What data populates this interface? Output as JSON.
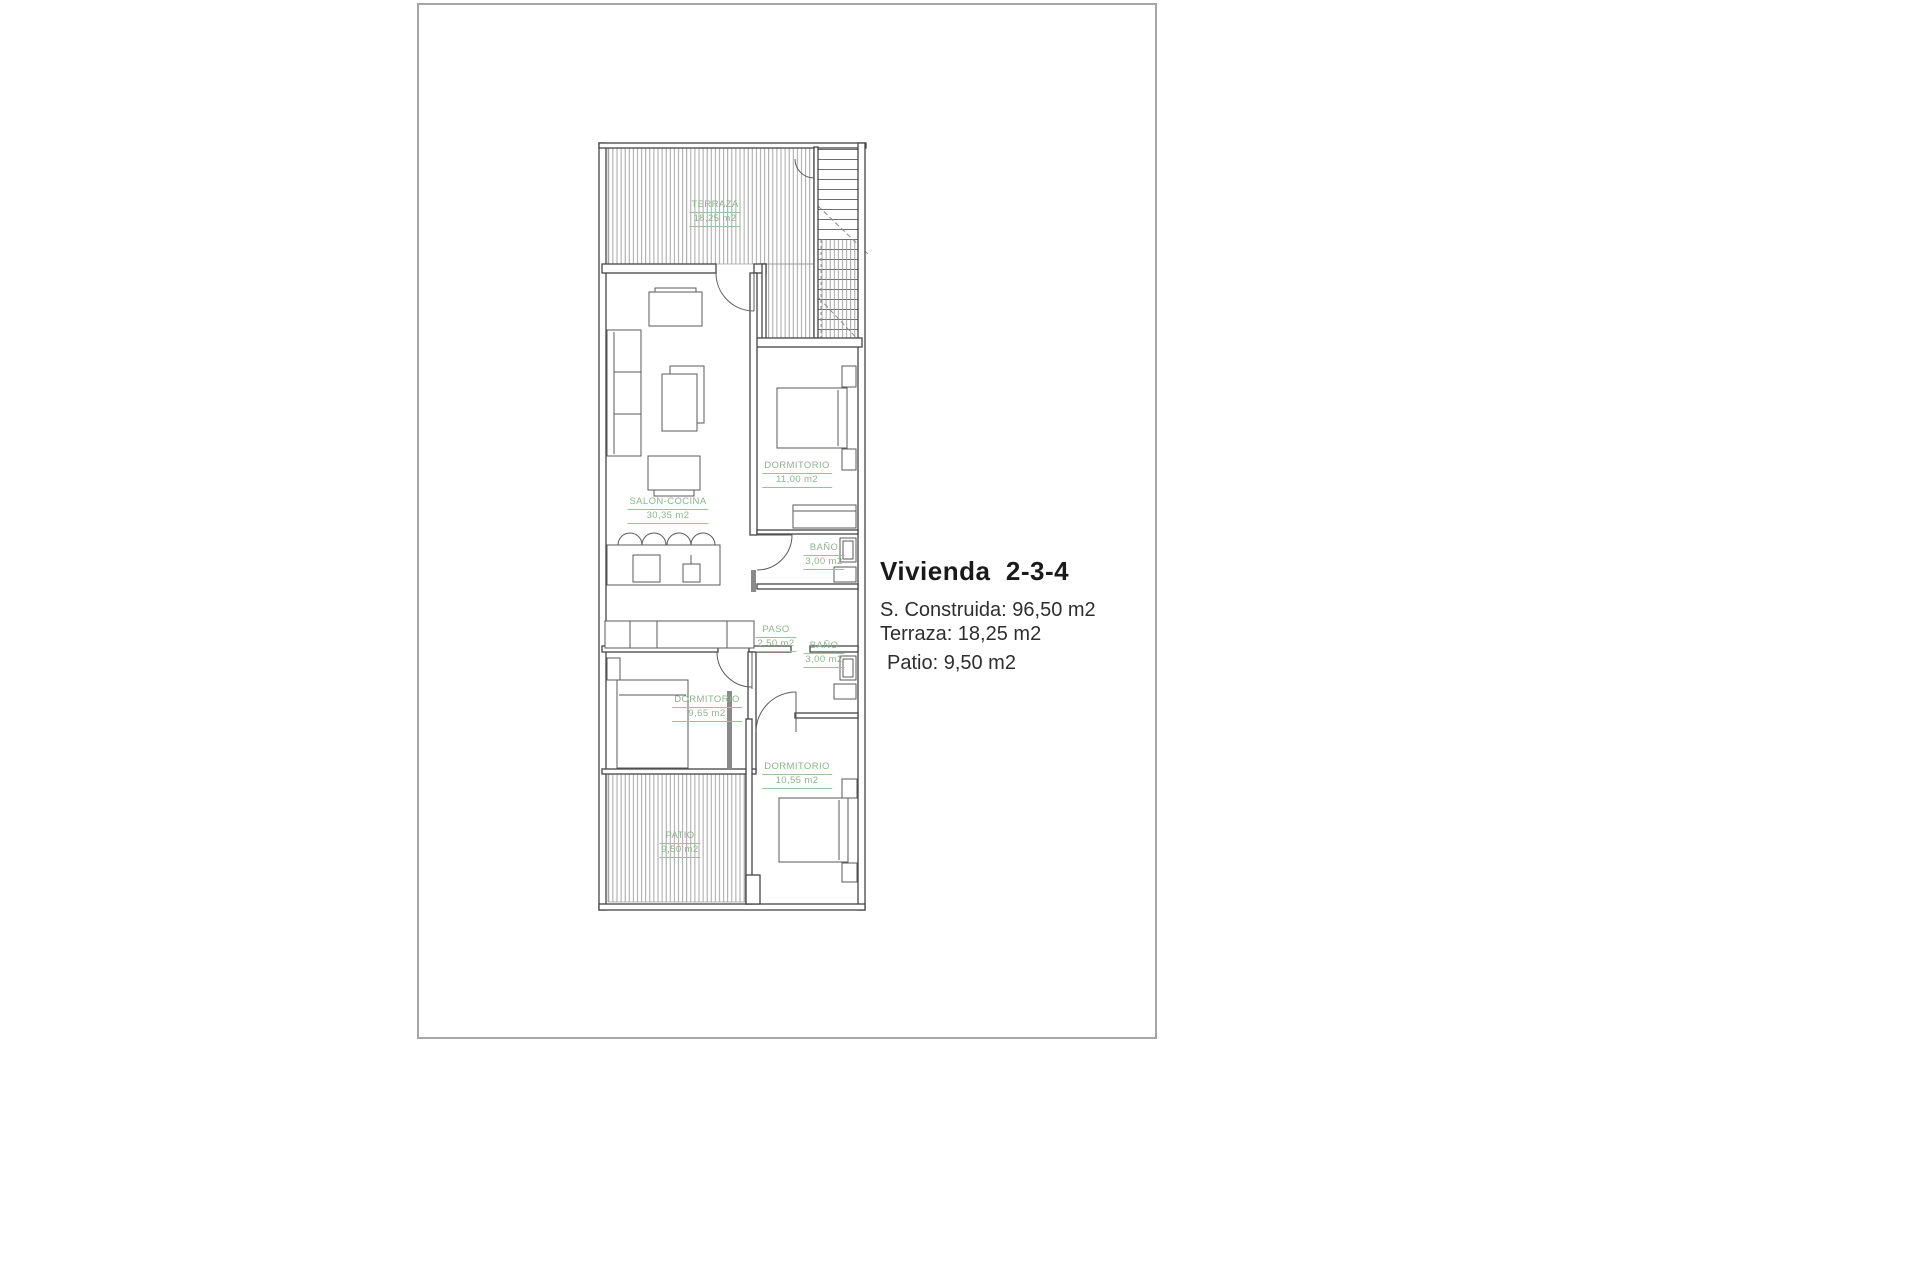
{
  "page": {
    "background": "#ffffff",
    "sheet_border_color": "#a6a6a6"
  },
  "info_panel": {
    "title": "Vivienda  2-3-4",
    "lines": [
      "S. Construida: 96,50 m2",
      "Terraza: 18,25 m2",
      "Patio: 9,50 m2"
    ]
  },
  "plan": {
    "wall_color": "#454545",
    "furniture_color": "#5a5a5a",
    "hatch_color": "#9b9b9b",
    "label_color": "#8fb28f",
    "rooms": [
      {
        "id": "terraza",
        "name": "TERRAZA",
        "area": "18,25 m2"
      },
      {
        "id": "salon",
        "name": "SALON-COCINA",
        "area": "30,35 m2"
      },
      {
        "id": "dorm1",
        "name": "DORMITORIO",
        "area": "11,00 m2"
      },
      {
        "id": "bano1",
        "name": "BAÑO",
        "area": "3,00 m2"
      },
      {
        "id": "paso",
        "name": "PASO",
        "area": "2,50 m2"
      },
      {
        "id": "bano2",
        "name": "BAÑO",
        "area": "3,00 m2"
      },
      {
        "id": "dorm2",
        "name": "DORMITORIO",
        "area": "9,65 m2"
      },
      {
        "id": "dorm3",
        "name": "DORMITORIO",
        "area": "10,55 m2"
      },
      {
        "id": "patio",
        "name": "PATIO",
        "area": "9,50 m2"
      }
    ]
  }
}
